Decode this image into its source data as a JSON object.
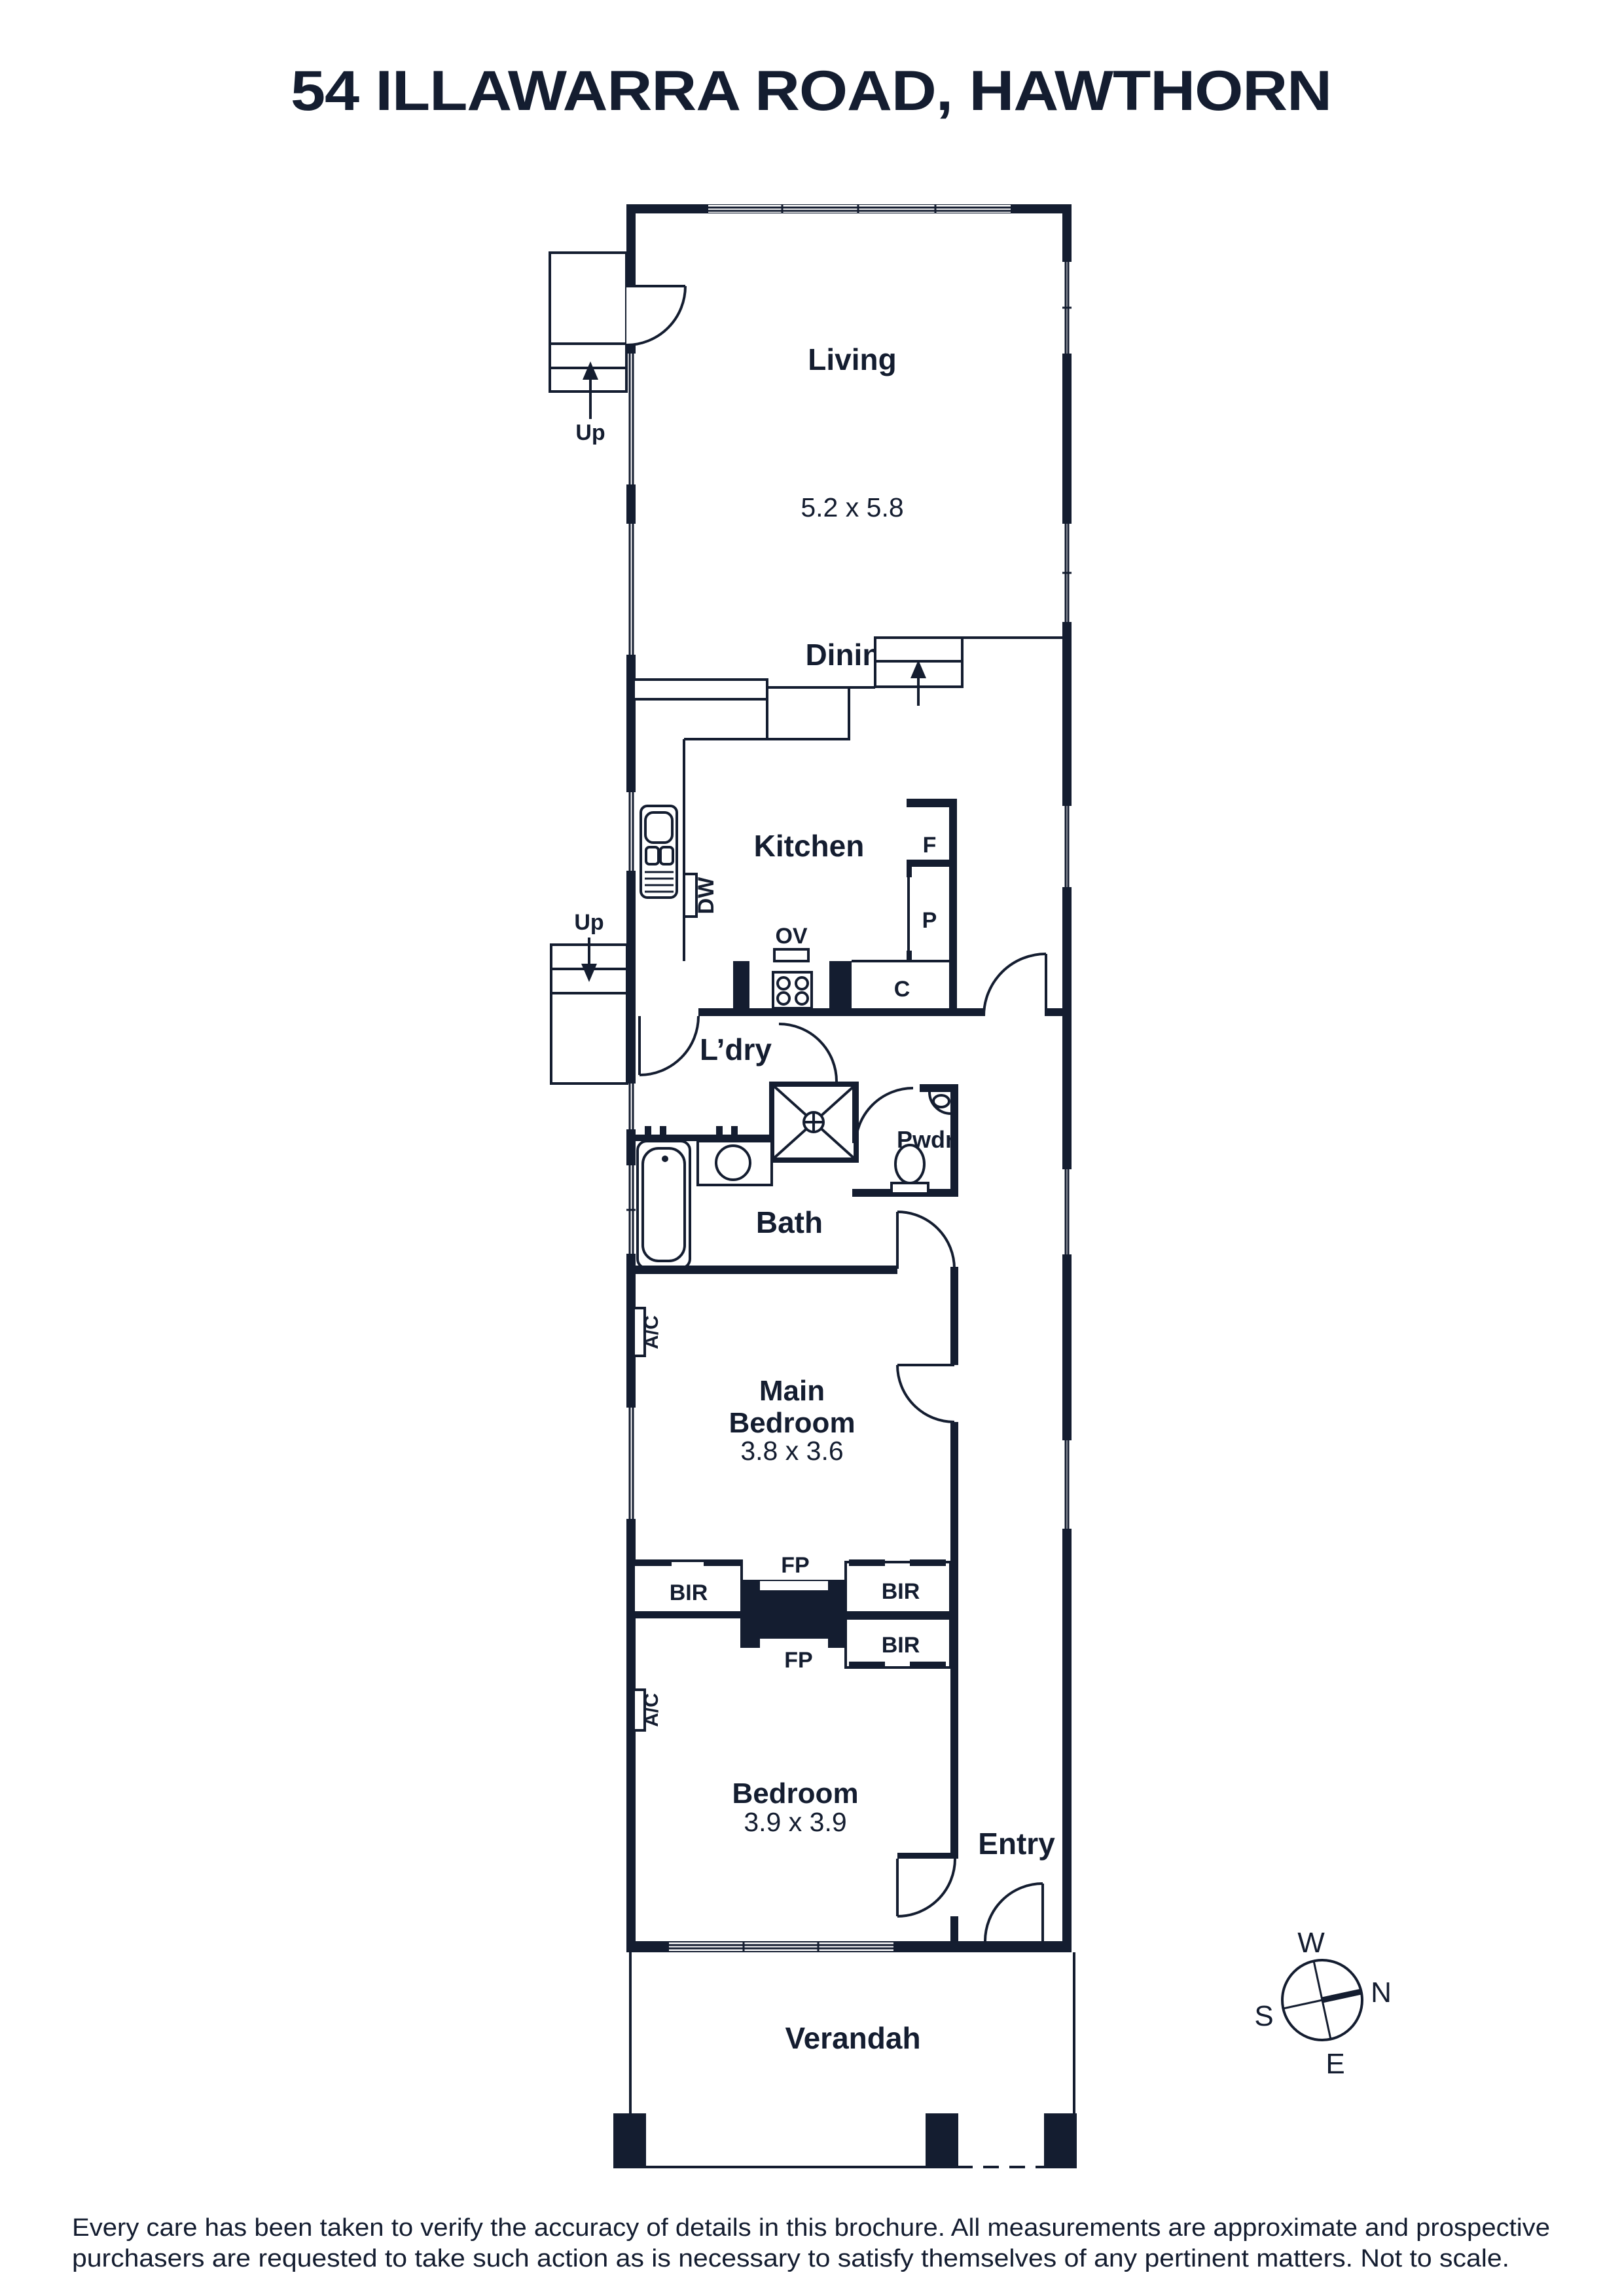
{
  "title": "54 ILLAWARRA ROAD, HAWTHORN",
  "colors": {
    "ink": "#141d30",
    "background": "#ffffff"
  },
  "rooms": {
    "living": {
      "label": "Living",
      "dims": "5.2 x 5.8"
    },
    "dining": {
      "label": "Dining"
    },
    "kitchen": {
      "label": "Kitchen"
    },
    "laundry": {
      "label": "L’dry"
    },
    "bath": {
      "label": "Bath"
    },
    "powder": {
      "label": "Pwdr"
    },
    "main_bedroom": {
      "label_line1": "Main",
      "label_line2": "Bedroom",
      "dims": "3.8 x 3.6"
    },
    "bedroom": {
      "label": "Bedroom",
      "dims": "3.9 x 3.9"
    },
    "entry": {
      "label": "Entry"
    },
    "verandah": {
      "label": "Verandah"
    }
  },
  "fixtures": {
    "dishwasher": "DW",
    "oven": "OV",
    "fridge": "F",
    "pantry": "P",
    "cupboard": "C",
    "built_in_robes": [
      "BIR",
      "BIR",
      "BIR"
    ],
    "fireplaces": [
      "FP",
      "FP"
    ],
    "air_conditioners": [
      "A/C",
      "A/C"
    ],
    "stairs_up": [
      "Up",
      "Up"
    ]
  },
  "compass": {
    "west": "W",
    "north": "N",
    "south": "S",
    "east": "E"
  },
  "disclaimer": {
    "line1": "Every care has been taken to verify the accuracy of details in this brochure. All measurements are approximate and prospective",
    "line2": "purchasers are requested to take such action as is necessary to satisfy themselves of any pertinent matters. Not to scale."
  }
}
